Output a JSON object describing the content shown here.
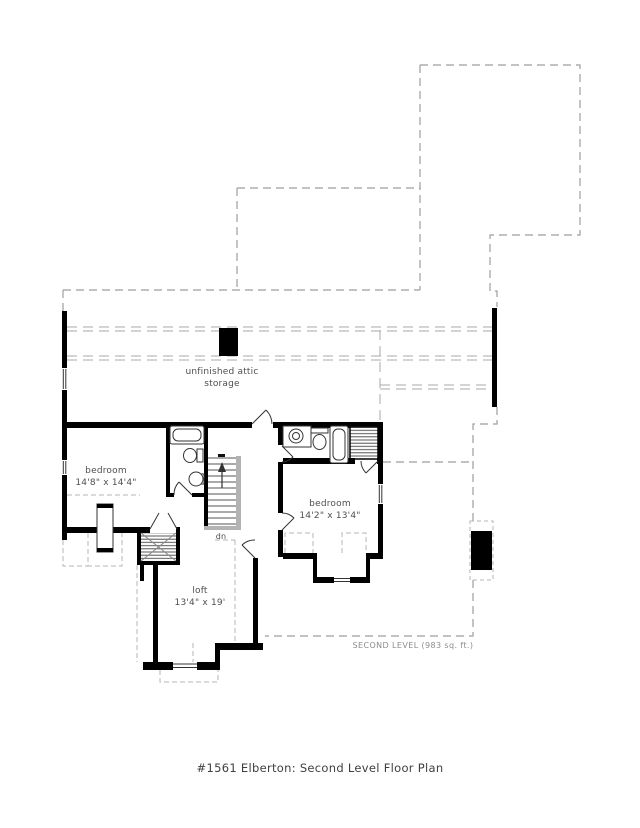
{
  "caption": "#1561 Elberton: Second Level Floor Plan",
  "level_note": "SECOND LEVEL (983 sq. ft.)",
  "rooms": {
    "attic": {
      "line1": "unfinished attic",
      "line2": "storage"
    },
    "bedroom_left": {
      "name": "bedroom",
      "dims": "14'8\" x 14'4\""
    },
    "bedroom_right": {
      "name": "bedroom",
      "dims": "14'2\" x 13'4\""
    },
    "loft": {
      "name": "loft",
      "dims": "13'4\" x 19'"
    }
  },
  "stairs": {
    "direction": "dn"
  },
  "colors": {
    "wall": "#000000",
    "roof_dashed": "#9e9e9e",
    "light_dashed": "#b5b5b5",
    "fixture_line": "#333333",
    "stair_rail": "#b3b3b3",
    "label_text": "#4f4f4f",
    "level_text": "#8c8c8c",
    "background": "#ffffff"
  }
}
